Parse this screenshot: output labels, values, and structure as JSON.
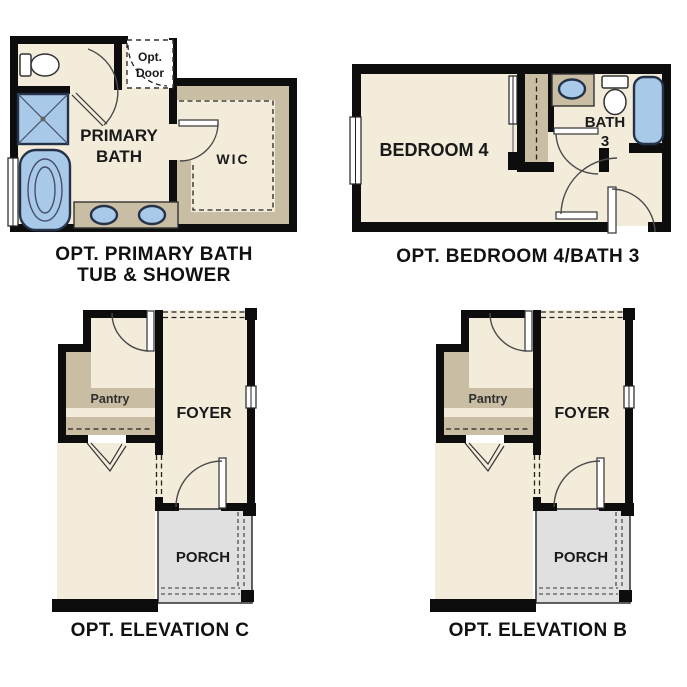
{
  "page": {
    "background": "#ffffff"
  },
  "palette": {
    "wall": "#0d0d0d",
    "room_fill": "#f4ecdb",
    "tan_fill": "#c9bda3",
    "porch_fill": "#e0e0e0",
    "fixture_blue": "#a9c9e8",
    "fixture_stroke": "#25334a",
    "text": "#1a1a1a"
  },
  "plans": {
    "primary_bath": {
      "caption_line1": "OPT. PRIMARY BATH",
      "caption_line2": "TUB & SHOWER",
      "room_label_line1": "PRIMARY",
      "room_label_line2": "BATH",
      "wic_label": "WIC",
      "opt_door_line1": "Opt.",
      "opt_door_line2": "Door",
      "fixtures": [
        "toilet-icon",
        "shower-icon",
        "bathtub-icon",
        "sink-icon",
        "sink-icon"
      ]
    },
    "bedroom4_bath3": {
      "caption": "OPT. BEDROOM 4/BATH 3",
      "bedroom_label": "BEDROOM 4",
      "bath_label_line1": "BATH",
      "bath_label_line2": "3",
      "fixtures": [
        "sink-icon",
        "toilet-icon",
        "bathtub-icon"
      ]
    },
    "elevation_c": {
      "caption": "OPT. ELEVATION C",
      "pantry_label": "Pantry",
      "foyer_label": "FOYER",
      "porch_label": "PORCH"
    },
    "elevation_b": {
      "caption": "OPT. ELEVATION B",
      "pantry_label": "Pantry",
      "foyer_label": "FOYER",
      "porch_label": "PORCH"
    }
  }
}
